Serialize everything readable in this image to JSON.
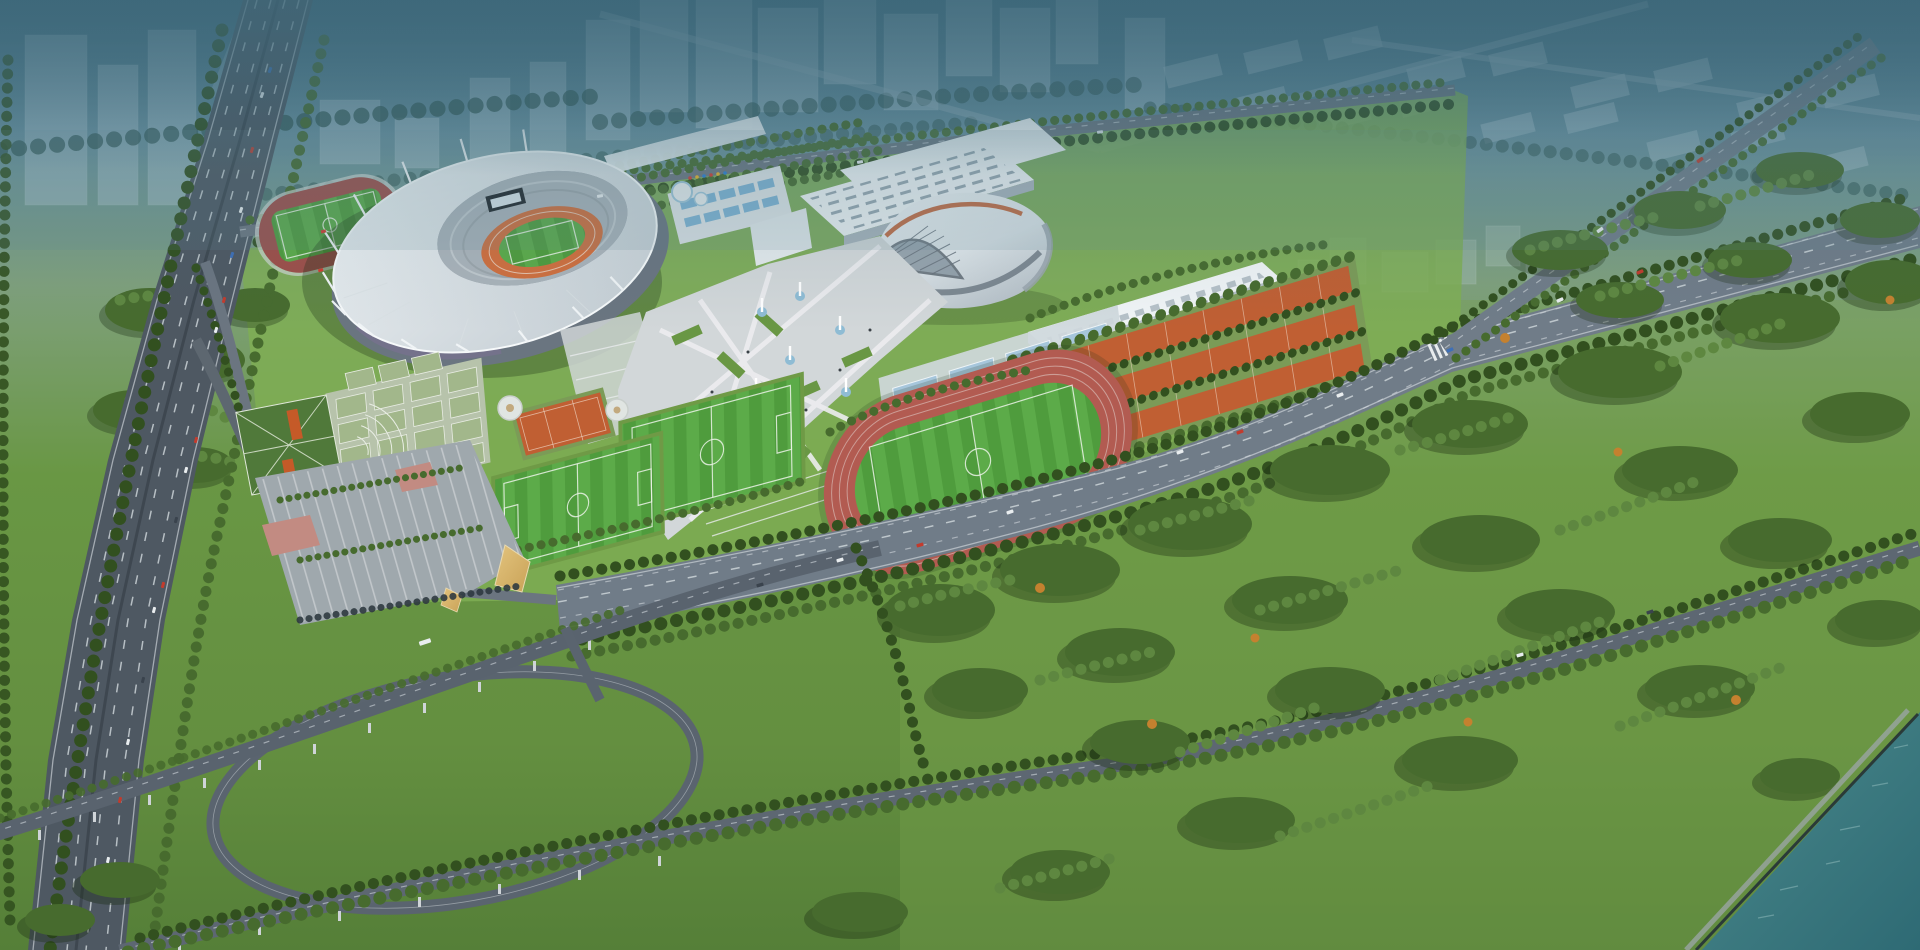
{
  "scene": {
    "type": "aerial-architectural-rendering",
    "subject": "sports-complex-masterplan"
  },
  "colors": {
    "sky_top": "#3f6b7d",
    "sky_mid": "#6a92a0",
    "grass_haze": "#7fa07c",
    "grass_bright": "#7fae54",
    "grass_mid": "#699744",
    "grass_dark": "#50793a",
    "haze_building": "#b7ccd6",
    "haze_forest": "#2f5450",
    "tree_dark": "#32501f",
    "tree_mid": "#476b2e",
    "tree_light": "#5e8740",
    "tree_autumn": "#c4812f",
    "asphalt": "#4e5862",
    "asphalt_light": "#707c88",
    "lane_mark": "#d2d9dd",
    "roof_white": "#f0f4f6",
    "roof_shade": "#c6cfd5",
    "facade": "#6a7580",
    "facade_purple": "#7b6f93",
    "glass": "#86949f",
    "track_orange": "#d06f3e",
    "track_rose": "#b25b51",
    "track_maroon": "#9e4f49",
    "pitch": "#4f9c3d",
    "pitch_light": "#5cab49",
    "clay": "#c05f33",
    "court_blue": "#a6c6db",
    "court_pale": "#a2b78b",
    "court_base": "#b7c3ab",
    "plaza": "#d2d7d9",
    "plaza_walk": "#ececee",
    "pink_paving": "#c28b82",
    "gold_roof": "#c9a257",
    "river": "#4b8a8c",
    "river_deep": "#2e6a74",
    "pier": "#cfd4d8",
    "screen": "#22282d",
    "pool_blue": "#7fb4d4",
    "stand_grey": "#aab3ba",
    "car_white": "#e9edef",
    "car_red": "#c23b2d",
    "car_blue": "#3e6fb7",
    "car_dark": "#3a434d",
    "flag_red": "#d23b30",
    "flag_yellow": "#e9b32a",
    "flag_blue": "#2a7fd3"
  }
}
